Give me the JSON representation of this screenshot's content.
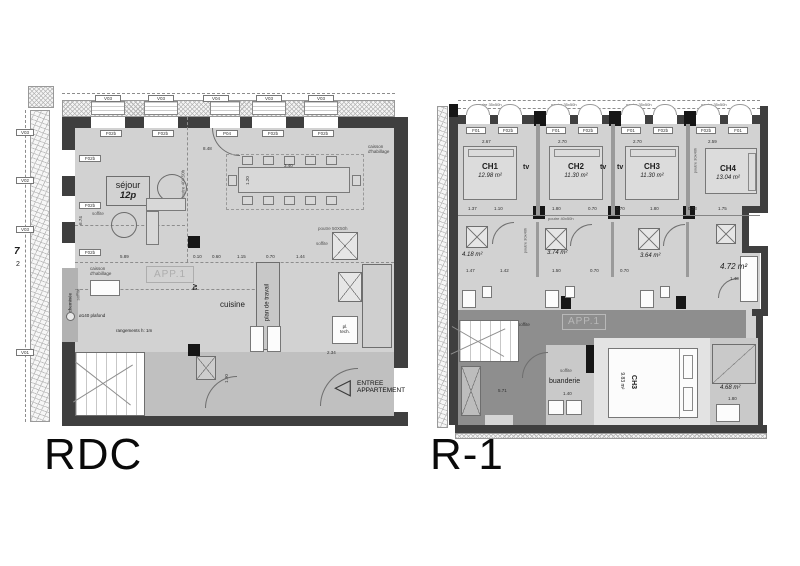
{
  "colors": {
    "background": "#ffffff",
    "room_fill": "#d2d2d2",
    "corridor_fill": "#8e8e8e",
    "wall_dark": "#3f3f3f",
    "column_black": "#161616"
  },
  "rdc": {
    "title": "RDC",
    "grid_num": "7",
    "grid_sub": "2",
    "window_tags_top": [
      "V03",
      "V03",
      "V04",
      "V03",
      "V03"
    ],
    "window_tags_left": [
      "V03",
      "V02",
      "V03",
      "V01"
    ],
    "opening_tags_top": [
      "F02b",
      "F02b",
      "P04",
      "F02b",
      "F02b"
    ],
    "opening_tags_left": [
      "F02b",
      "F02b",
      "F02b"
    ],
    "stair_tag": "F02b",
    "room_sejour": "séjour",
    "room_sejour_cap": "12p",
    "room_app": "APP.1",
    "room_tv": "tv",
    "room_cuisine": "cuisine",
    "room_plan_travail": "plan de travail",
    "pl_tech_1": "pl.",
    "pl_tech_2": "tech.",
    "entree_1": "ENTREE",
    "entree_2": "APPARTEMENT",
    "entree_arrow": "◁",
    "caisson_1": "caisson",
    "caisson_2": "d'habillage",
    "cheminee": "cheminée",
    "plafond": "ø140 plafond",
    "rangements": "rangements h: 1m",
    "soffite": "soffite",
    "poutre_v": "poutre 40X50h",
    "poutre_h": "poutre 50X50h",
    "dim_top": "8.48",
    "dim_table_l": "3.40",
    "dim_table_w": "1.20",
    "dims_beam": [
      "5.89",
      "0.10",
      "0.60",
      "1.15",
      "0.70",
      "1.44",
      "0.60"
    ],
    "dim_entry": "2.34",
    "dim_corridor": "1.90",
    "dim_left": "6.74"
  },
  "r1": {
    "title": "R-1",
    "beam_top": "poutre 35x50h",
    "beam_mid": "poutre 40x50h",
    "beam_rot": "poutre 30x40h",
    "tag_f01": "F01",
    "tag_f02b": "F02b",
    "tv": "tv",
    "bedrooms": [
      {
        "name": "CH1",
        "area": "12.98 m²",
        "dim": "2.67"
      },
      {
        "name": "CH2",
        "area": "11.30 m²",
        "dim": "2.70"
      },
      {
        "name": "CH3",
        "area": "11.30 m²",
        "dim": "2.70"
      },
      {
        "name": "CH4",
        "area": "13.04 m²",
        "dim": "2.59"
      }
    ],
    "baths": [
      "4.18 m²",
      "3.74 m²",
      "3.64 m²",
      "4.72 m²"
    ],
    "bath_dims": [
      "1.47",
      "1.42",
      "1.50",
      "0.70",
      "0.70",
      "1.40"
    ],
    "mid_dims": [
      "1.37",
      "1.10",
      "1.80",
      "0.70",
      "0.70",
      "1.80",
      "0.73",
      "1.75"
    ],
    "app": "APP.1",
    "soffite": "soffite",
    "buanderie": "buanderie",
    "ch3_name": "CH3",
    "ch3_area": "9.83 m²",
    "room_right": "4.68 m²",
    "dim_bottom": "5.71",
    "dim_buanderie": "1.40",
    "dim_right": "1.80"
  }
}
